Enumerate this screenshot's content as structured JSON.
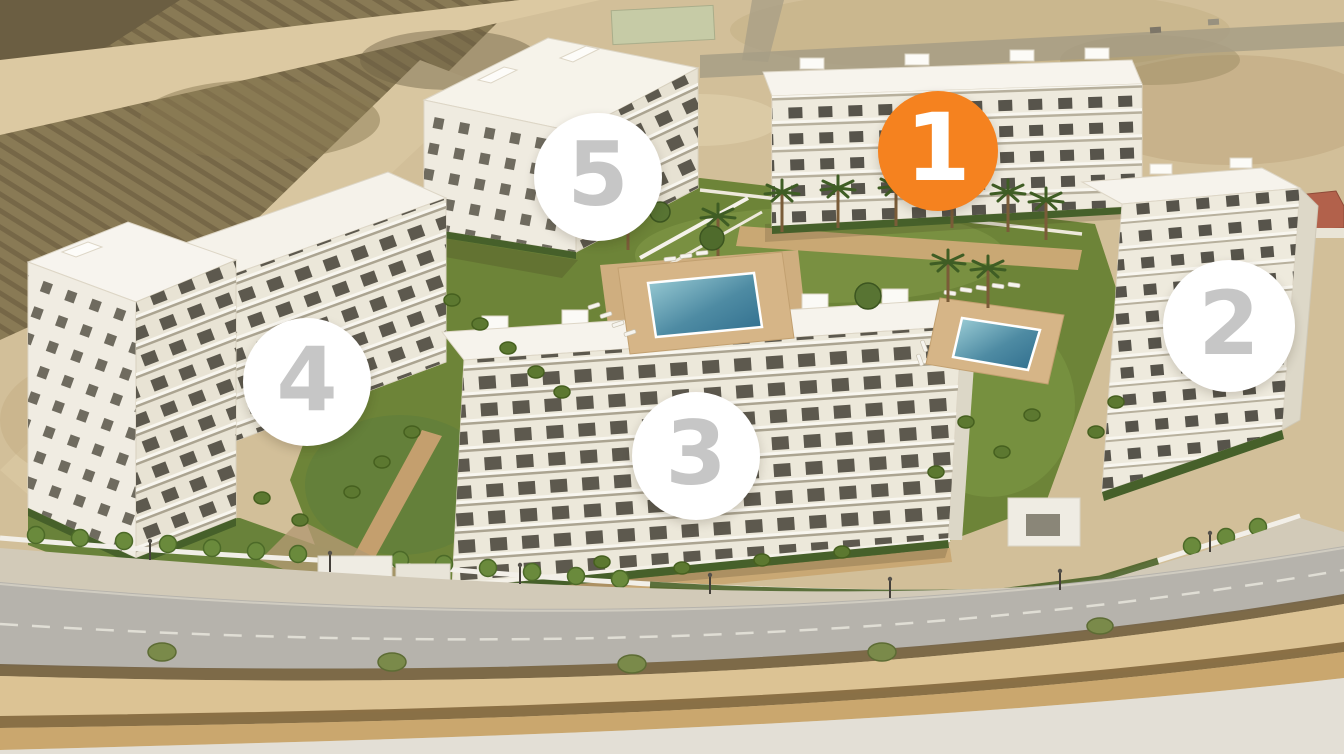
{
  "page": {
    "title": "Residential development aerial plan with numbered building phases",
    "building_count": "5"
  },
  "markers": [
    {
      "number": "1",
      "building": "building-1",
      "state": "active"
    },
    {
      "number": "2",
      "building": "building-2",
      "state": "inactive"
    },
    {
      "number": "3",
      "building": "building-3",
      "state": "inactive"
    },
    {
      "number": "4",
      "building": "building-4",
      "state": "inactive"
    },
    {
      "number": "5",
      "building": "building-5",
      "state": "inactive"
    }
  ],
  "colors": {
    "marker-active-bg": "#F5821F",
    "marker-active-text": "#FFFFFF",
    "marker-inactive-bg": "#FFFFFF",
    "marker-inactive-text": "#C6C6C6"
  }
}
